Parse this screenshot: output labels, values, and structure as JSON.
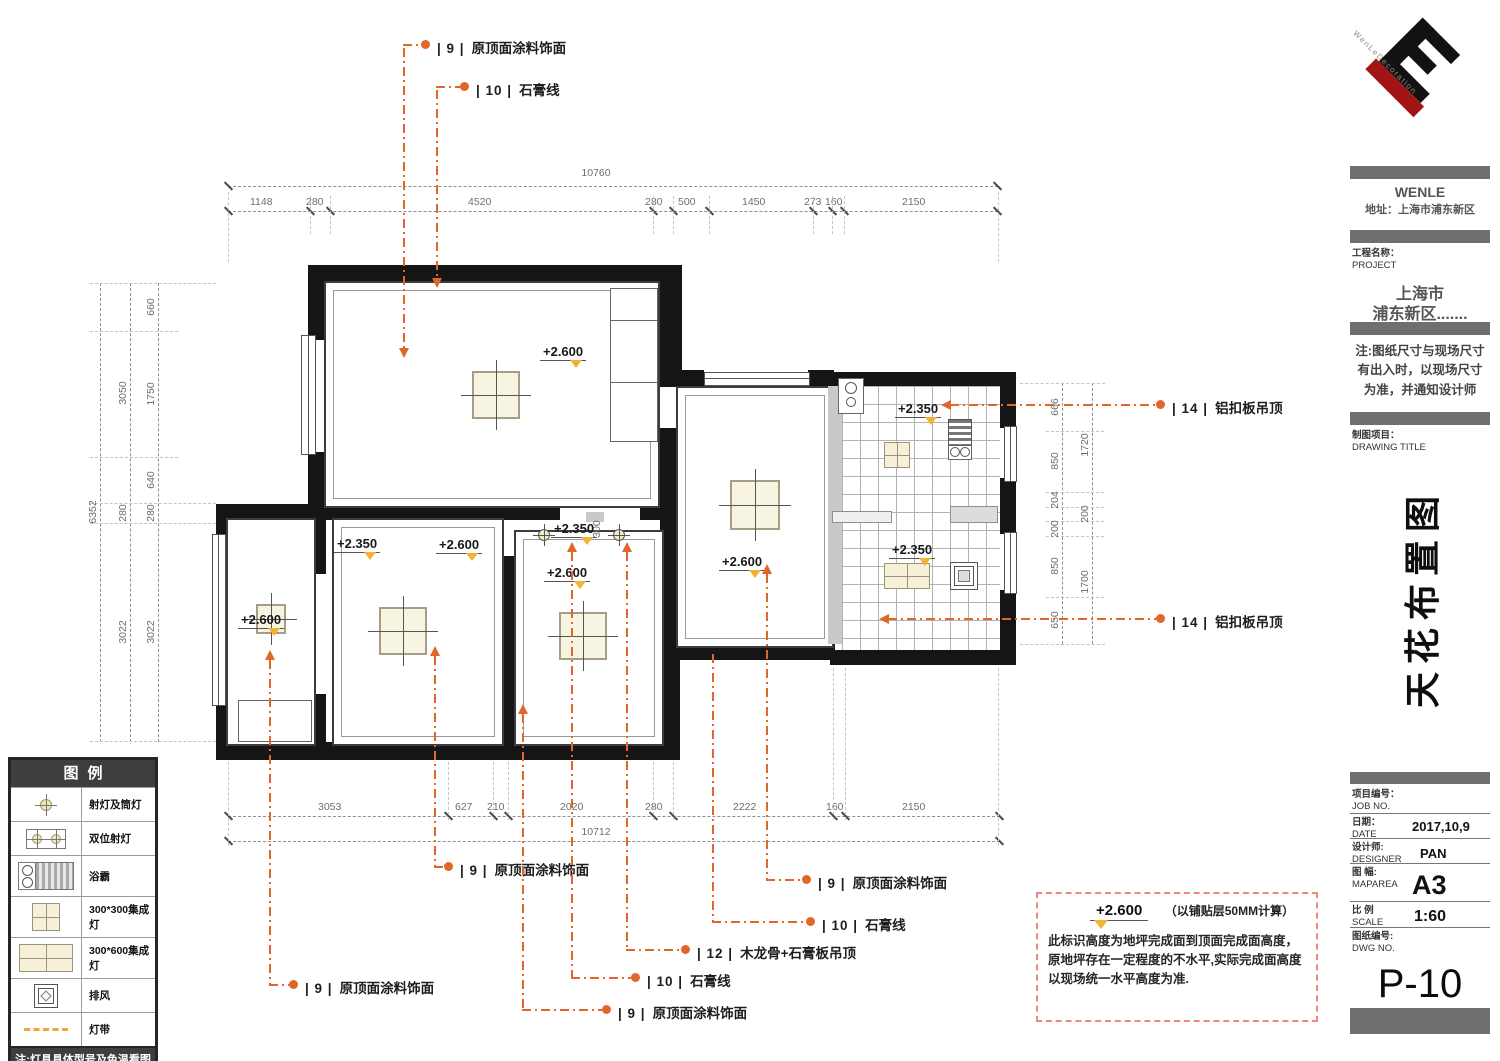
{
  "colors": {
    "accent_orange": "#E1662A",
    "marker_yellow": "#F2B232",
    "wall_black": "#151515",
    "bar_gray": "#6F6F6F",
    "note_border_pink": "#F08784",
    "legend_header_bg": "#3E3E40"
  },
  "logo": {
    "text": "WenLeDecoration"
  },
  "titleblock": {
    "company": "WENLE",
    "address": "地址：上海市浦东新区",
    "project_label": "工程名称：",
    "project_label_en": "PROJECT",
    "project_line1": "上海市",
    "project_line2": "浦东新区.......",
    "site_note": "注:图纸尺寸与现场尺寸有出入时，以现场尺寸为准，并通知设计师",
    "drawing_label": "制图项目：",
    "drawing_label_en": "DRAWING TITLE",
    "drawing_title": "天花布置图",
    "fields": [
      {
        "label": "项目编号：",
        "label_en": "JOB NO.",
        "value": ""
      },
      {
        "label": "日期：",
        "label_en": "DATE",
        "value": "2017,10,9"
      },
      {
        "label": "设计师:",
        "label_en": "DESIGNER",
        "value": "PAN"
      },
      {
        "label": "图 幅:",
        "label_en": "MAPAREA",
        "value": "A3"
      },
      {
        "label": "比 例",
        "label_en": "SCALE",
        "value": "1:60"
      },
      {
        "label": "图纸编号:",
        "label_en": "DWG NO.",
        "value": "P-10"
      }
    ]
  },
  "legend": {
    "title": "图例",
    "items": [
      {
        "symbol": "spotlight",
        "label": "射灯及筒灯"
      },
      {
        "symbol": "double-spotlight",
        "label": "双位射灯"
      },
      {
        "symbol": "bath-heater",
        "label": "浴霸"
      },
      {
        "symbol": "panel-300x300",
        "label": "300*300集成灯"
      },
      {
        "symbol": "panel-300x600",
        "label": "300*600集成灯"
      },
      {
        "symbol": "exhaust-fan",
        "label": "排风"
      },
      {
        "symbol": "light-strip",
        "label": "灯带"
      }
    ],
    "footnote": "注:灯具具体型号及色温看图纸详细标识"
  },
  "annotations": {
    "top": [
      {
        "tag": "| 9 |",
        "text": "原顶面涂料饰面"
      },
      {
        "tag": "| 10 |",
        "text": "石膏线"
      }
    ],
    "right": [
      {
        "tag": "| 14 |",
        "text": "铝扣板吊顶"
      },
      {
        "tag": "| 14 |",
        "text": "铝扣板吊顶"
      }
    ],
    "bottom": [
      {
        "tag": "| 9 |",
        "text": "原顶面涂料饰面"
      },
      {
        "tag": "| 9 |",
        "text": "原顶面涂料饰面"
      },
      {
        "tag": "| 10 |",
        "text": "石膏线"
      },
      {
        "tag": "| 12 |",
        "text": "木龙骨+石膏板吊顶"
      },
      {
        "tag": "| 10 |",
        "text": "石膏线"
      },
      {
        "tag": "| 9 |",
        "text": "原顶面涂料饰面"
      },
      {
        "tag": "| 9 |",
        "text": "原顶面涂料饰面"
      }
    ]
  },
  "dims": {
    "top": {
      "total": "10760",
      "segments": [
        "1148",
        "280",
        "4520",
        "280",
        "500",
        "1450",
        "273",
        "160",
        "2150"
      ]
    },
    "bottom": {
      "total": "10712",
      "segments": [
        "3053",
        "627",
        "210",
        "2020",
        "280",
        "2222",
        "160",
        "2150"
      ]
    },
    "left": {
      "outer": "6352",
      "middle": [
        "3050",
        "280",
        "3022"
      ],
      "inner": [
        "660",
        "1750",
        "640",
        "280",
        "3022"
      ]
    },
    "right": {
      "outer": [
        "1720",
        "200",
        "1700"
      ],
      "inner": [
        "666",
        "850",
        "204",
        "200",
        "850",
        "650"
      ]
    },
    "corridor": "300"
  },
  "elevations": {
    "room_a": "+2.600",
    "room_c_low": "+2.350",
    "room_c": "+2.600",
    "corridor": "+2.350",
    "room_d": "+2.600",
    "balcony": "+2.600",
    "living": "+2.600",
    "kitchen": "+2.350",
    "bath": "+2.350"
  },
  "note_box": {
    "elevation": "+2.600",
    "suffix": "（以铺贴层50MM计算）",
    "body": "此标识高度为地坪完成面到顶面完成面高度，原地坪存在一定程度的不水平,实际完成面高度以现场统一水平高度为准."
  }
}
